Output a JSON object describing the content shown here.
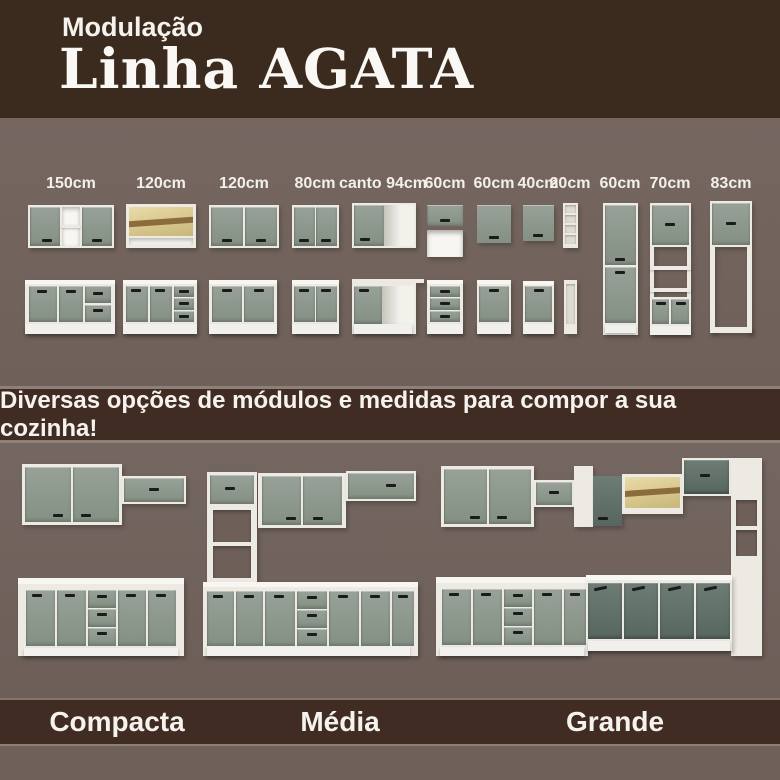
{
  "header": {
    "kicker": "Modulação",
    "title": "Linha AGATA"
  },
  "modules": {
    "labels": [
      "150cm",
      "120cm",
      "120cm",
      "80cm",
      "canto 94cm",
      "60cm",
      "60cm",
      "40cm",
      "20cm",
      "60cm",
      "70cm",
      "83cm"
    ]
  },
  "banner": {
    "text": "Diversas opções de módulos e medidas para compor a sua cozinha!"
  },
  "kitchens": {
    "sizes": [
      {
        "name": "Compacta"
      },
      {
        "name": "Média"
      },
      {
        "name": "Grande"
      }
    ]
  },
  "colors": {
    "background_brown": "#3b2b1e",
    "background_taupe": "#70625a",
    "band_brown": "#402c23",
    "cabinet_green": "#8f9990",
    "cabinet_dark_green": "#5f6e68",
    "carcass_white": "#eceae3",
    "glass_wood_yellow": "#dcca90",
    "text_white": "#f6f3ef"
  }
}
